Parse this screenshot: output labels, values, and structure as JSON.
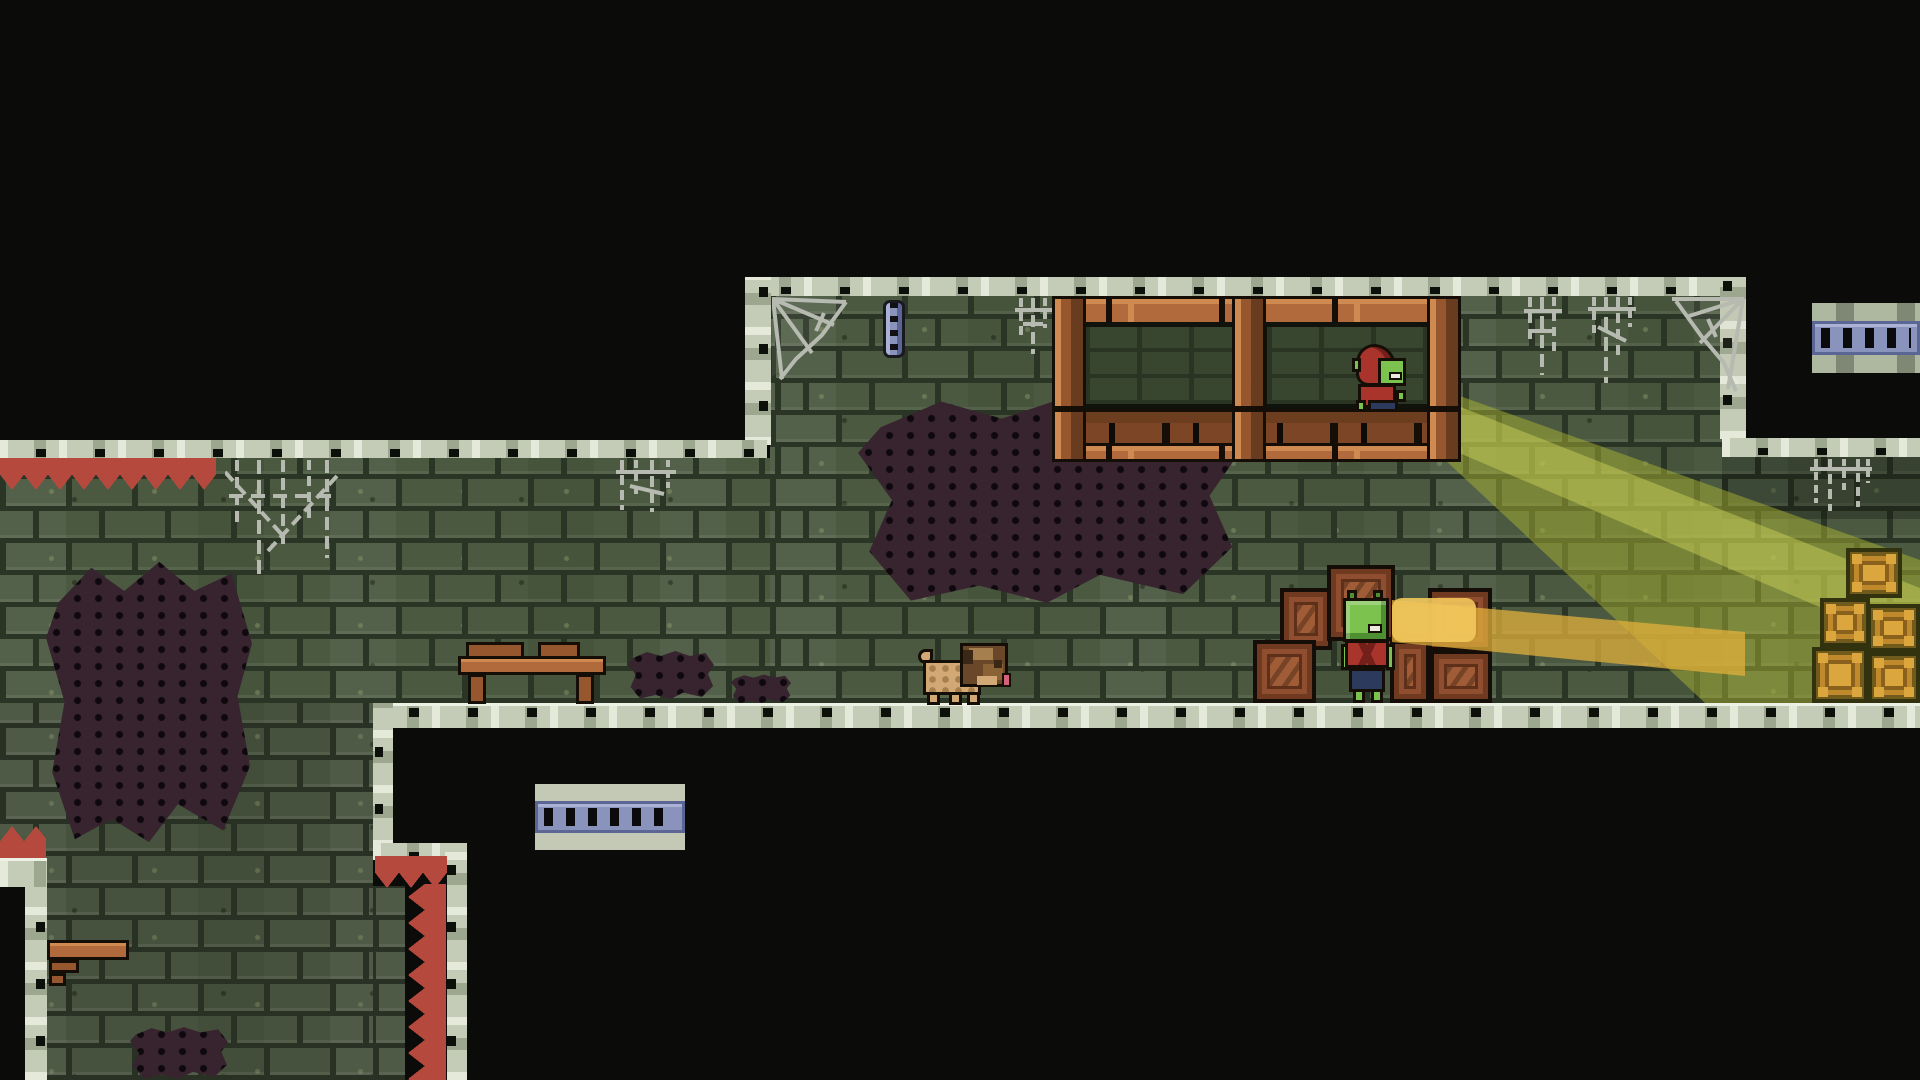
{
  "scene": {
    "title": "pixel-art dungeon platformer level",
    "description": "Side-view dungeon of green bricks outlined with pale stone blocks. A red-hooded goblin lookout stands on a wooden balcony shining a yellow-green light beam down-right toward gold crates. A second goblin stands among wooden crates on the floor while a pug walks nearby. Red spikes, cobwebs, wall stains, a small table, a shelf and two vents decorate the level.",
    "visible_text": [],
    "hud": []
  },
  "palette": {
    "bg": "#0b0b09",
    "mortar": "#2b3526",
    "brick": "#4a5940",
    "stone": "#c4cbb6",
    "stone-hi": "#e4e9da",
    "stone-mid": "#9da68f",
    "stone-dark": "#707b64",
    "notch": "#0d0f0a",
    "wood": "#b06a3c",
    "wood-hi": "#cf8a52",
    "wood-mid": "#96562e",
    "wood-dark": "#6d3d20",
    "outline": "#150e07",
    "red": "#b5493e",
    "red-dk": "#7c2a22",
    "grn": "#7cc24f",
    "grn-dk": "#4e8f31",
    "cloth": "#a9342b",
    "cloth-dk": "#741f19",
    "pants": "#2c3a5e",
    "tan": "#d2a874",
    "tan-dk": "#a57f4d",
    "brown": "#6b4729",
    "brown-dk": "#3a2715",
    "tongue": "#d4607a",
    "gold": "#c08a2c",
    "gold-hi": "#dca63f",
    "gold-dk": "#8a611c",
    "gold-ln": "#32320f",
    "blue": "#8993bb",
    "blue-hi": "#aab3d6",
    "blue-dk": "#5c6694",
    "web": "#b6bab0",
    "stain": "#37242f",
    "beam": "rgba(167,178,48,0.50)",
    "beam-c": "rgba(208,214,94,0.45)",
    "beam2": "rgba(226,176,60,0.75)",
    "beam2h": "rgba(242,200,92,0.90)"
  },
  "characters": [
    {
      "id": "gb1",
      "species": "goblin",
      "outfit": "red hood, blue pants",
      "facing": "right",
      "location": "wooden balcony",
      "action": "shining light beam down-right"
    },
    {
      "id": "gb2",
      "species": "goblin",
      "outfit": "red shirt, dark blue pants",
      "facing": "right",
      "location": "between floor crates",
      "action": "standing, short gold glow at face"
    },
    {
      "id": "pug",
      "species": "pug dog",
      "facing": "right",
      "location": "main floor",
      "action": "walking"
    }
  ],
  "entities": [
    {
      "id": "g-a",
      "name": "wall-main-room",
      "kind": "brick-wall",
      "x": 770,
      "y": 296,
      "w": 952,
      "h": 407
    },
    {
      "id": "g-b",
      "name": "wall-left-wing",
      "kind": "brick-wall",
      "x": 0,
      "y": 458,
      "w": 770,
      "h": 245
    },
    {
      "id": "g-c",
      "name": "wall-lower-left",
      "kind": "brick-wall",
      "x": 0,
      "y": 703,
      "w": 373,
      "h": 377
    },
    {
      "id": "g-c2",
      "name": "wall-lower-left-ext",
      "kind": "brick-wall",
      "x": 373,
      "y": 886,
      "w": 36,
      "h": 194
    },
    {
      "id": "g-d",
      "name": "wall-right-passage",
      "kind": "brick-wall",
      "x": 1722,
      "y": 457,
      "w": 198,
      "h": 246
    },
    {
      "id": "shade-passage",
      "name": "passage-shadow",
      "kind": "shade",
      "x": 1722,
      "y": 457,
      "w": 198,
      "h": 62
    },
    {
      "id": "st-main",
      "name": "wall-stain-center",
      "kind": "stain",
      "x": 858,
      "y": 393,
      "w": 378,
      "h": 214
    },
    {
      "id": "st-left",
      "name": "wall-stain-left",
      "kind": "stain",
      "x": 46,
      "y": 556,
      "w": 206,
      "h": 292
    },
    {
      "id": "st-f1",
      "name": "floor-stain-1",
      "kind": "stain",
      "x": 628,
      "y": 650,
      "w": 86,
      "h": 50
    },
    {
      "id": "st-f2",
      "name": "floor-stain-2",
      "kind": "stain",
      "x": 731,
      "y": 674,
      "w": 60,
      "h": 30
    },
    {
      "id": "st-bl",
      "name": "stain-bottom-left",
      "kind": "stain",
      "x": 130,
      "y": 1026,
      "w": 98,
      "h": 54
    },
    {
      "id": "beam1",
      "name": "light-beam-outer",
      "kind": "light",
      "x": 1443,
      "y": 368,
      "w": 477,
      "h": 342
    },
    {
      "id": "beam1c",
      "name": "light-beam-core",
      "kind": "light",
      "x": 1443,
      "y": 388,
      "w": 477,
      "h": 270
    },
    {
      "id": "b-top",
      "name": "border-main-top",
      "kind": "stone-band",
      "x": 745,
      "y": 277,
      "w": 1000,
      "h": 19
    },
    {
      "id": "b-lwall",
      "name": "border-main-left",
      "kind": "stone-band",
      "x": 745,
      "y": 277,
      "w": 26,
      "h": 168
    },
    {
      "id": "b-rwall",
      "name": "border-main-right",
      "kind": "stone-band",
      "x": 1720,
      "y": 277,
      "w": 26,
      "h": 162
    },
    {
      "id": "b-lceil",
      "name": "border-left-ceiling",
      "kind": "stone-band",
      "x": 0,
      "y": 440,
      "w": 767,
      "h": 18
    },
    {
      "id": "b-ptop",
      "name": "border-passage-top",
      "kind": "stone-band",
      "x": 1722,
      "y": 438,
      "w": 198,
      "h": 19
    },
    {
      "id": "b-floor",
      "name": "border-floor",
      "kind": "stone-band",
      "x": 373,
      "y": 703,
      "w": 1547,
      "h": 25
    },
    {
      "id": "b-sv1",
      "name": "border-step-vertical-1",
      "kind": "stone-band",
      "x": 373,
      "y": 703,
      "w": 20,
      "h": 145
    },
    {
      "id": "b-sh",
      "name": "border-step-horizontal",
      "kind": "stone-band",
      "x": 373,
      "y": 843,
      "w": 94,
      "h": 17
    },
    {
      "id": "b-sv2",
      "name": "border-step-vertical-2",
      "kind": "stone-band",
      "x": 445,
      "y": 843,
      "w": 22,
      "h": 237
    },
    {
      "id": "b-pcol",
      "name": "border-pit-column",
      "kind": "stone-band",
      "x": 25,
      "y": 858,
      "w": 22,
      "h": 222
    },
    {
      "id": "b-pcap",
      "name": "border-pit-cap",
      "kind": "stone-band",
      "x": 0,
      "y": 858,
      "w": 47,
      "h": 29
    },
    {
      "id": "blk-pit",
      "name": "pit-black",
      "kind": "void",
      "x": 0,
      "y": 887,
      "w": 25,
      "h": 193
    },
    {
      "id": "blk-gap",
      "name": "spike-gap-black",
      "kind": "void",
      "x": 405,
      "y": 858,
      "w": 42,
      "h": 222
    },
    {
      "id": "sp-ceil",
      "name": "spikes-ceiling-down",
      "kind": "spikes",
      "x": 0,
      "y": 458,
      "w": 216,
      "h": 32
    },
    {
      "id": "sp-step",
      "name": "spikes-step-down",
      "kind": "spikes",
      "x": 375,
      "y": 856,
      "w": 72,
      "h": 32
    },
    {
      "id": "sp-col",
      "name": "spikes-column-left",
      "kind": "spikes",
      "x": 408,
      "y": 884,
      "w": 38,
      "h": 196
    },
    {
      "id": "sp-pit",
      "name": "spikes-pit-up",
      "kind": "spikes",
      "x": 0,
      "y": 826,
      "w": 46,
      "h": 32
    },
    {
      "id": "vent-tr",
      "name": "vent-top-right",
      "kind": "vent",
      "x": 1812,
      "y": 303,
      "w": 108,
      "h": 70
    },
    {
      "id": "vent-bl",
      "name": "vent-bottom-left",
      "kind": "vent",
      "x": 535,
      "y": 784,
      "w": 150,
      "h": 66
    },
    {
      "id": "chain",
      "name": "wall-chain",
      "kind": "prop",
      "x": 883,
      "y": 300,
      "w": 22,
      "h": 58
    },
    {
      "id": "web-cl",
      "name": "cobweb-corner-left",
      "kind": "cobweb",
      "x": 772,
      "y": 297,
      "w": 78,
      "h": 84
    },
    {
      "id": "web-s1",
      "name": "cobweb-strands-1",
      "kind": "cobweb",
      "x": 1013,
      "y": 298,
      "w": 44,
      "h": 58
    },
    {
      "id": "web-s2",
      "name": "cobweb-strands-2",
      "kind": "cobweb",
      "x": 1522,
      "y": 297,
      "w": 118,
      "h": 88
    },
    {
      "id": "web-cr",
      "name": "cobweb-corner-right",
      "kind": "cobweb",
      "x": 1666,
      "y": 297,
      "w": 79,
      "h": 98
    },
    {
      "id": "web-p",
      "name": "cobweb-passage",
      "kind": "cobweb",
      "x": 1806,
      "y": 459,
      "w": 72,
      "h": 54
    },
    {
      "id": "web-b",
      "name": "cobweb-big-left",
      "kind": "cobweb",
      "x": 225,
      "y": 460,
      "w": 114,
      "h": 122
    },
    {
      "id": "web-s3",
      "name": "cobweb-strands-3",
      "kind": "cobweb",
      "x": 612,
      "y": 460,
      "w": 70,
      "h": 54
    },
    {
      "id": "bal",
      "name": "wooden-balcony",
      "kind": "structure",
      "x": 1052,
      "y": 296,
      "w": 403,
      "h": 113
    },
    {
      "id": "gb1",
      "name": "goblin-lookout",
      "kind": "character",
      "x": 1352,
      "y": 344,
      "w": 58,
      "h": 77
    },
    {
      "id": "balr",
      "name": "wooden-balcony-railing",
      "kind": "structure",
      "x": 1052,
      "y": 409,
      "w": 403,
      "h": 53
    },
    {
      "id": "table",
      "name": "wooden-table",
      "kind": "prop",
      "x": 458,
      "y": 642,
      "w": 148,
      "h": 62
    },
    {
      "id": "shelf",
      "name": "wall-shelf",
      "kind": "prop",
      "x": 47,
      "y": 940,
      "w": 82,
      "h": 53
    },
    {
      "id": "pug",
      "name": "pug-dog",
      "kind": "character",
      "x": 918,
      "y": 643,
      "w": 93,
      "h": 62
    },
    {
      "id": "c1",
      "name": "crate-1",
      "kind": "crate",
      "x": 1280,
      "y": 588,
      "w": 52,
      "h": 62
    },
    {
      "id": "c2",
      "name": "crate-2",
      "kind": "crate",
      "x": 1327,
      "y": 565,
      "w": 68,
      "h": 76
    },
    {
      "id": "c3",
      "name": "crate-3",
      "kind": "crate",
      "x": 1253,
      "y": 640,
      "w": 63,
      "h": 63
    },
    {
      "id": "c4",
      "name": "crate-4",
      "kind": "crate",
      "x": 1390,
      "y": 640,
      "w": 40,
      "h": 63
    },
    {
      "id": "c5",
      "name": "crate-5",
      "kind": "crate",
      "x": 1428,
      "y": 588,
      "w": 64,
      "h": 63
    },
    {
      "id": "c6",
      "name": "crate-6",
      "kind": "crate",
      "x": 1430,
      "y": 650,
      "w": 62,
      "h": 53
    },
    {
      "id": "gg1",
      "name": "gold-crate-1",
      "kind": "gold-crate",
      "x": 1846,
      "y": 548,
      "w": 56,
      "h": 50
    },
    {
      "id": "gg2",
      "name": "gold-crate-2",
      "kind": "gold-crate",
      "x": 1820,
      "y": 598,
      "w": 50,
      "h": 49
    },
    {
      "id": "gg3",
      "name": "gold-crate-3",
      "kind": "gold-crate",
      "x": 1867,
      "y": 604,
      "w": 53,
      "h": 48
    },
    {
      "id": "gg4",
      "name": "gold-crate-4",
      "kind": "gold-crate",
      "x": 1812,
      "y": 647,
      "w": 56,
      "h": 56
    },
    {
      "id": "gg5",
      "name": "gold-crate-5",
      "kind": "gold-crate",
      "x": 1868,
      "y": 652,
      "w": 52,
      "h": 51
    },
    {
      "id": "beam2",
      "name": "gold-glow-beam",
      "kind": "light",
      "x": 1392,
      "y": 596,
      "w": 353,
      "h": 84
    },
    {
      "id": "beam2h",
      "name": "gold-glow-hotspot",
      "kind": "light",
      "x": 1392,
      "y": 598,
      "w": 84,
      "h": 44
    },
    {
      "id": "gb2",
      "name": "goblin-ground",
      "kind": "character",
      "x": 1341,
      "y": 590,
      "w": 54,
      "h": 113
    }
  ]
}
